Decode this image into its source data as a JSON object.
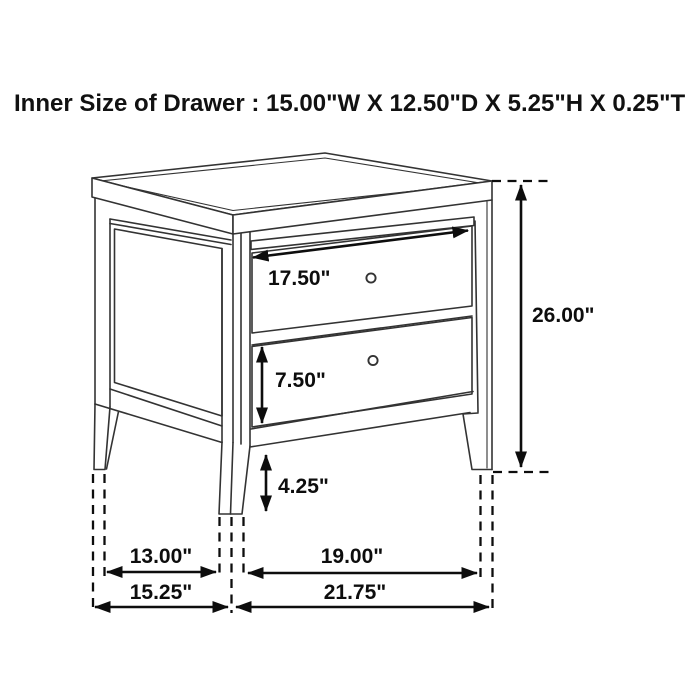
{
  "title": "Inner Size of Drawer : 15.00\"W X 12.50\"D X 5.25\"H X 0.25\"T",
  "drawing": {
    "description": "2-drawer nightstand in three-quarter perspective line drawing",
    "knob_count": 2
  },
  "dimensions": {
    "drawer_front_width": "17.50\"",
    "overall_height": "26.00\"",
    "drawer_front_height": "7.50\"",
    "leg_height": "4.25\"",
    "side_leg_span": "13.00\"",
    "front_leg_span": "19.00\"",
    "overall_depth": "15.25\"",
    "overall_width": "21.75\""
  },
  "colors": {
    "background": "#ffffff",
    "line": "#333333",
    "dimension": "#0d0d0d",
    "text": "#111111"
  }
}
